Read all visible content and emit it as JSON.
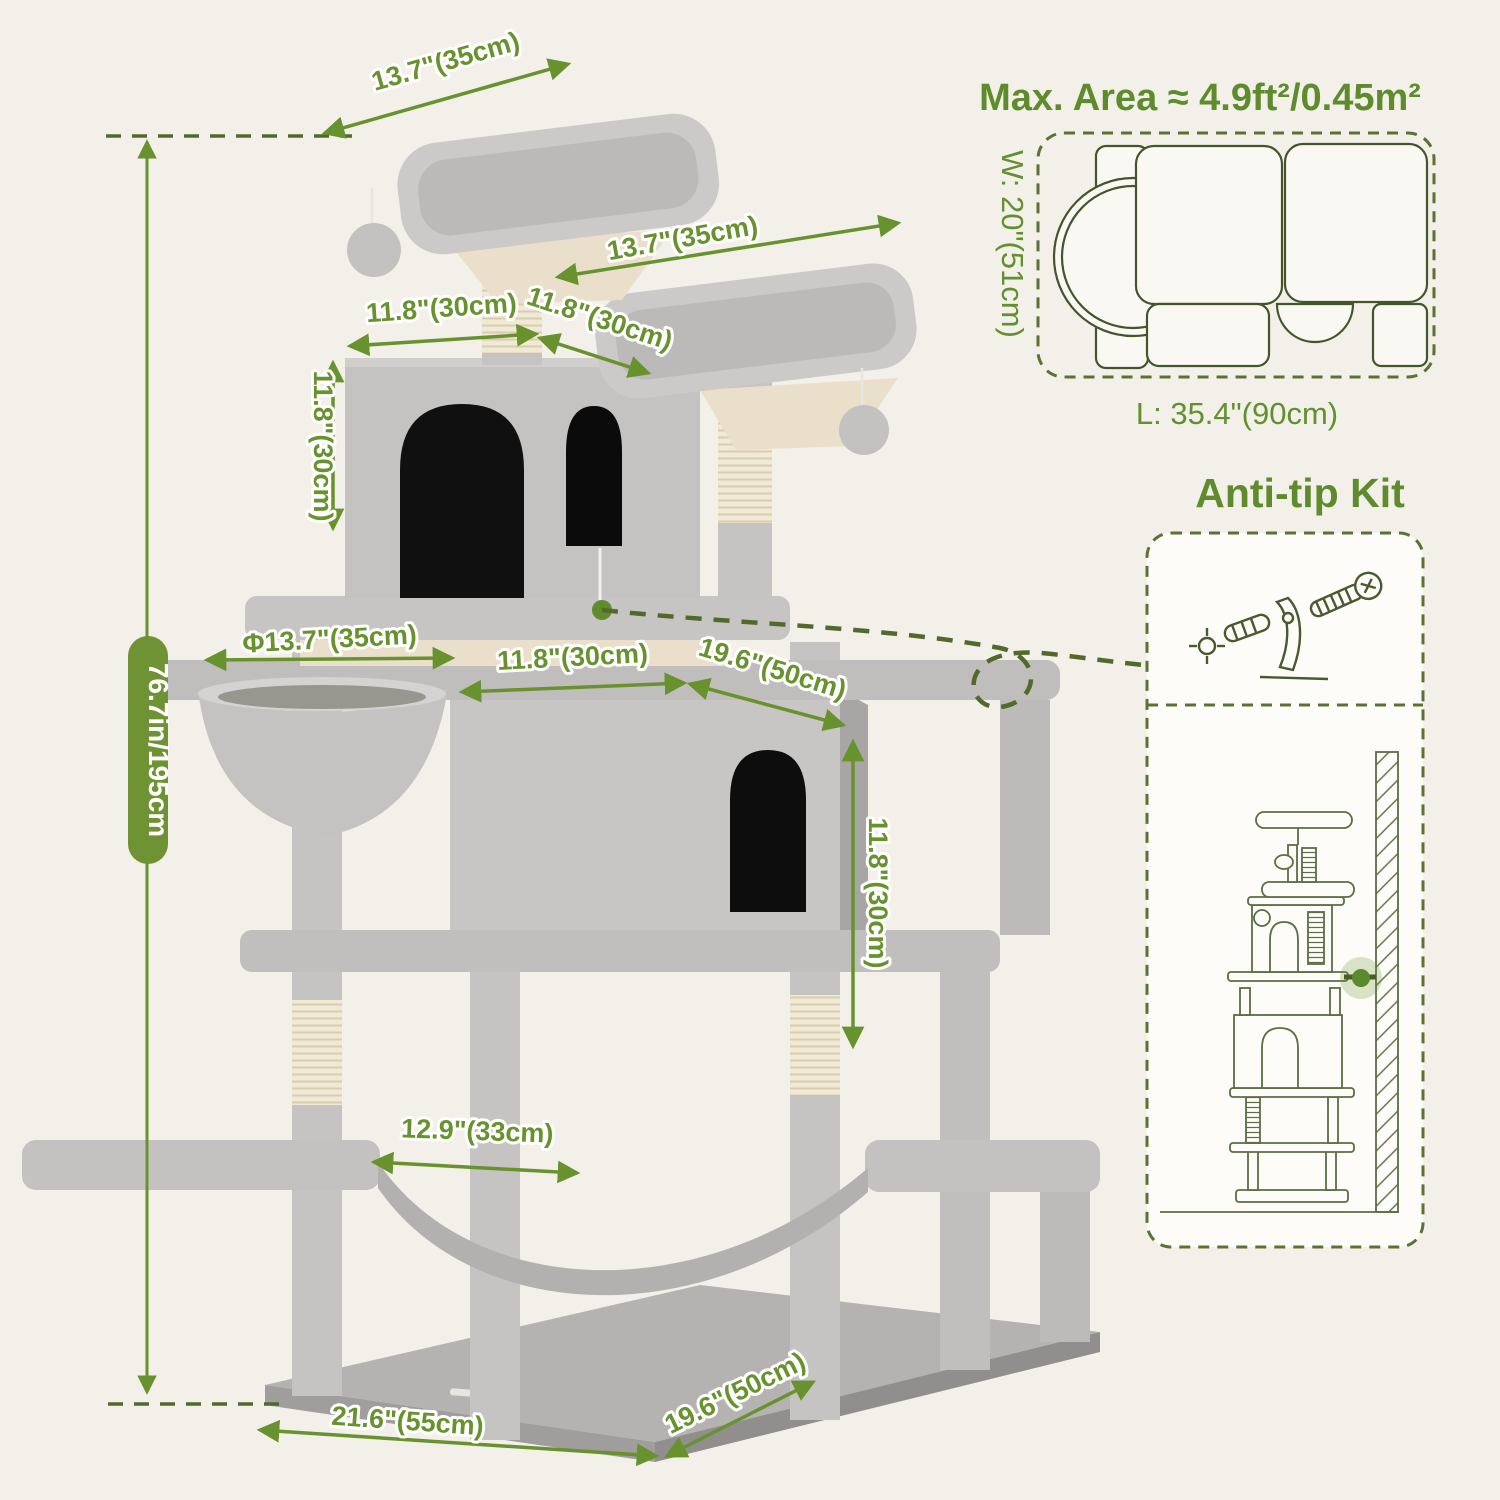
{
  "colors": {
    "background": "#f3efe9",
    "accent_green": "#67922e",
    "dark_olive": "#5d7134",
    "pill_green": "#6f9334",
    "tree_gray": "#c6c5c3",
    "sisal_beige": "#f0e9d5",
    "opening_black": "#0d0d0d"
  },
  "dimensions": {
    "top_platform": "13.7\"(35cm)",
    "upper_platform": "13.7\"(35cm)",
    "condo_width": "11.8\"(30cm)",
    "upper_platform_depth": "11.8\"(30cm)",
    "condo_height": "11.8\"(30cm)",
    "total_height": "76.7in/195cm",
    "basket_diameter": "Φ13.7\"(35cm)",
    "middle_width": "11.8\"(30cm)",
    "large_condo_depth": "19.6\"(50cm)",
    "large_condo_height": "11.8\"(30cm)",
    "hammock_width": "12.9\"(33cm)",
    "base_width": "21.6\"(55cm)",
    "base_depth": "19.6\"(50cm)"
  },
  "max_area": {
    "title": "Max. Area ≈ 4.9ft²/0.45m²",
    "width_label": "W: 20\"(51cm)",
    "length_label": "L: 35.4\"(90cm)"
  },
  "anti_tip": {
    "title": "Anti-tip Kit"
  }
}
